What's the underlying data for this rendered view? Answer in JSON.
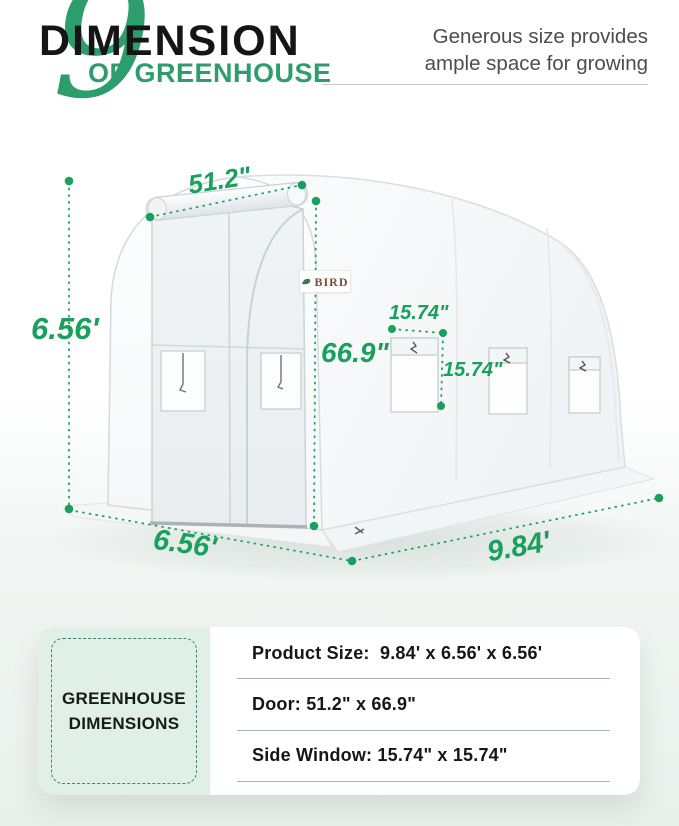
{
  "header": {
    "numeral": "9",
    "title": "DIMENSION",
    "subtitle": "OF GREENHOUSE",
    "tagline": [
      "Generous size provides",
      "ample space for growing"
    ]
  },
  "brand": {
    "name": "BIRD"
  },
  "dimensions": {
    "door_width": "51.2\"",
    "frame_height": "6.56'",
    "door_height": "66.9\"",
    "window_width": "15.74\"",
    "window_height": "15.74\"",
    "base_depth": "6.56'",
    "base_length": "9.84'"
  },
  "summary": {
    "card_title": [
      "GREENHOUSE",
      "DIMENSIONS"
    ],
    "rows": [
      "Product Size:  9.84' x 6.56' x 6.56'",
      "Door: 51.2\" x 66.9\"",
      "Side Window: 15.74\" x 15.74\""
    ]
  },
  "colors": {
    "accent_green": "#18a05c",
    "title_green": "#2e9d6e",
    "mint_panel": "#e0efe8",
    "dashed_border": "#3e8671"
  }
}
